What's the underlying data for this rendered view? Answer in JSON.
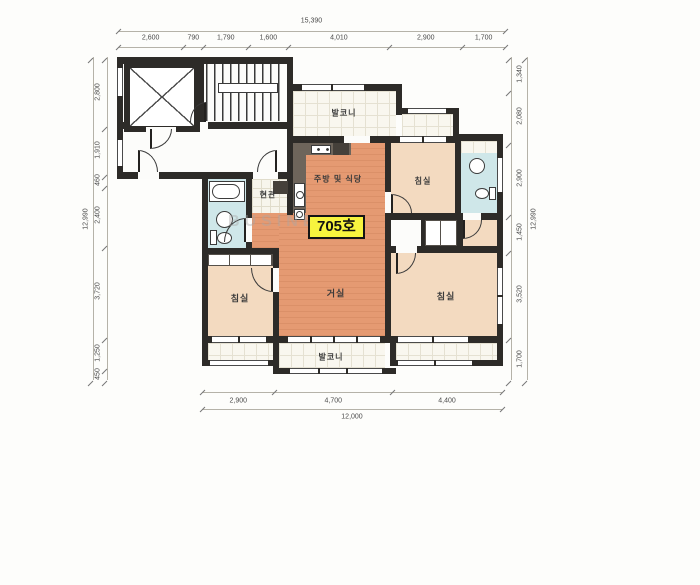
{
  "unit_label": "705호",
  "watermark": "BUSINESS",
  "rooms": {
    "balcony_top": "발코니",
    "kitchen": "주방 및 식당",
    "entrance": "현관",
    "bedroom_top_right": "침실",
    "living": "거실",
    "bedroom_left": "침실",
    "bedroom_right": "침실",
    "balcony_bottom": "발코니"
  },
  "dimensions": {
    "top": {
      "total": "15,390",
      "segments": [
        "2,600",
        "790",
        "1,790",
        "1,600",
        "4,010",
        "2,900",
        "1,700"
      ]
    },
    "bottom": {
      "total": "12,000",
      "segments": [
        "2,900",
        "4,700",
        "4,400"
      ]
    },
    "left": {
      "total": "12,990",
      "segments": [
        "2,800",
        "1,910",
        "460",
        "2,400",
        "3,720",
        "1,250",
        "450"
      ]
    },
    "right": {
      "total": "12,990",
      "segments": [
        "1,340",
        "2,080",
        "2,900",
        "1,450",
        "3,520",
        "1,700"
      ]
    }
  },
  "colors": {
    "wall": "#2d2b28",
    "living_floor": "#e59a72",
    "bedroom_floor": "#f3dac0",
    "bathroom_floor": "#cfe7e9",
    "balcony_tile": "#f9f7ef",
    "counter": "#6e655b",
    "unit_label_bg": "#f7f43e"
  }
}
